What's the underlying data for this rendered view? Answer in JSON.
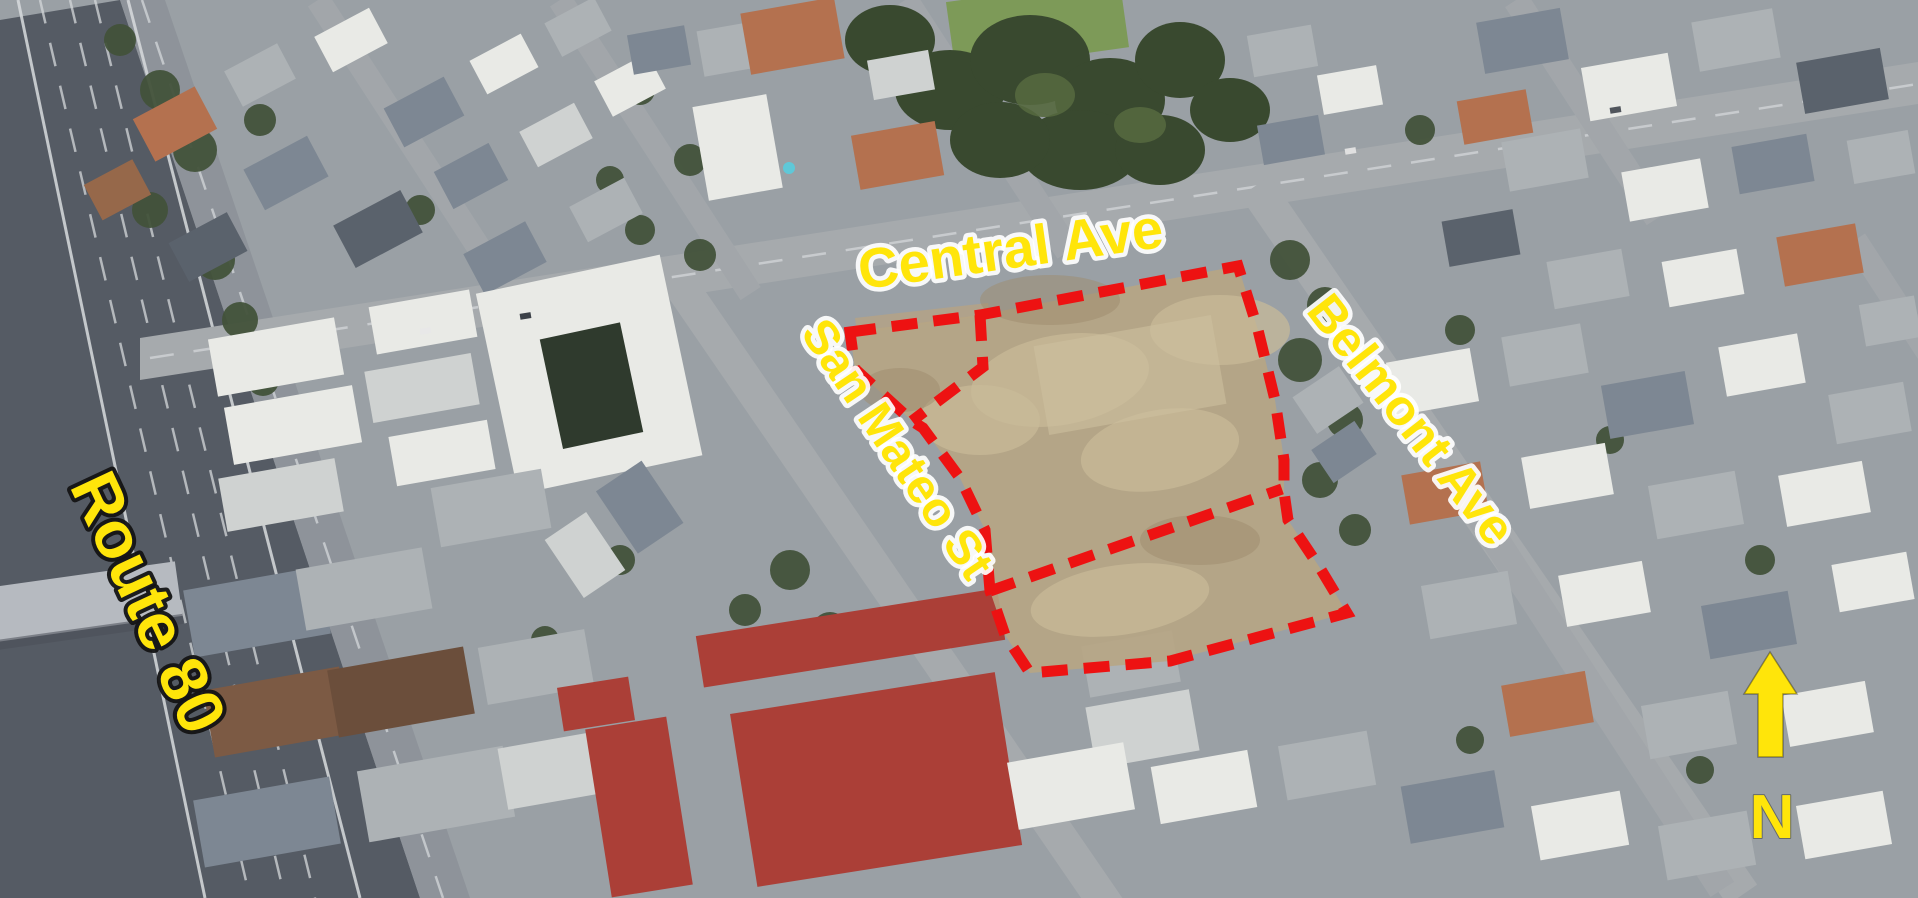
{
  "map": {
    "view": "annotated aerial photograph of development site",
    "labels": {
      "route80": {
        "text": "Route 80"
      },
      "central": {
        "text": "Central Ave"
      },
      "san_mateo": {
        "text": "San Mateo St"
      },
      "belmont": {
        "text": "Belmont Ave"
      }
    },
    "north_arrow": {
      "letter": "N"
    },
    "colors": {
      "label_yellow": "#FFE50A",
      "boundary_red": "#ED1212",
      "route_label_outline": "#141414",
      "street_label_outline": "#FFFFFF"
    },
    "site_boundary": {
      "stroke_style": "dashed",
      "paths": [
        {
          "name": "site-outline",
          "closed": true,
          "points": [
            [
              850,
              332
            ],
            [
              980,
              315
            ],
            [
              1238,
              266
            ],
            [
              1258,
              330
            ],
            [
              1275,
              400
            ],
            [
              1284,
              460
            ],
            [
              1284,
              492
            ],
            [
              1288,
              520
            ],
            [
              1320,
              568
            ],
            [
              1347,
              613
            ],
            [
              1170,
              661
            ],
            [
              1030,
              673
            ],
            [
              1005,
              635
            ],
            [
              990,
              591
            ],
            [
              985,
              530
            ],
            [
              960,
              478
            ],
            [
              923,
              428
            ],
            [
              912,
              421
            ],
            [
              855,
              369
            ]
          ]
        },
        {
          "name": "corner-parcel-divider",
          "closed": false,
          "points": [
            [
              980,
              315
            ],
            [
              983,
              367
            ],
            [
              912,
              421
            ]
          ]
        },
        {
          "name": "south-parcel-divider",
          "closed": false,
          "points": [
            [
              990,
              591
            ],
            [
              1282,
              489
            ]
          ]
        }
      ]
    }
  }
}
